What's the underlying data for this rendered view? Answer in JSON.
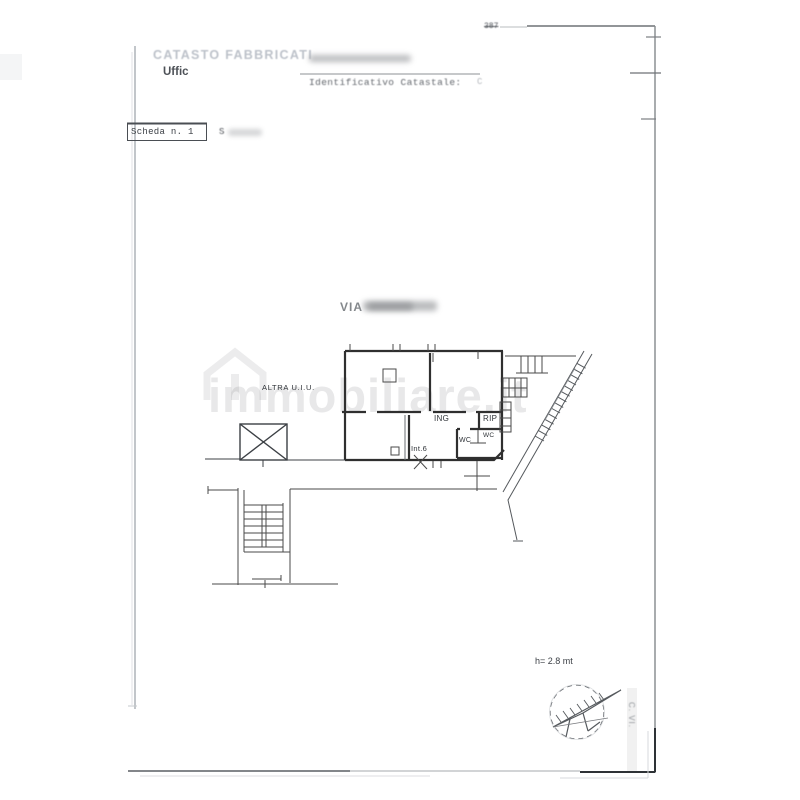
{
  "document": {
    "type_label": "CATASTO FABBRICATI",
    "office_label": "Uffic",
    "page_note": "387",
    "identifier_label": "Identificativo Catastale:",
    "identifier_value": "C",
    "scheda_label": "Scheda n. 1",
    "scale_prefix": "S"
  },
  "plan": {
    "street_label": "VIA",
    "room_labels": {
      "altra_uiu": "ALTRA U.I.U.",
      "ing": "ING",
      "rip": "RIP",
      "wc_left": "WC",
      "wc_right": "WC",
      "unit": "Int.6"
    },
    "height_note": "h= 2.8 mt"
  },
  "watermark": {
    "text": "immobiliare.it"
  },
  "margin_note": {
    "text": "C. VI."
  },
  "colors": {
    "wall": "#2f2f2f",
    "line": "#4a4a4a",
    "light_line": "#9aa0a6",
    "faded_header": "#bcc1c9",
    "paper": "#ffffff"
  }
}
